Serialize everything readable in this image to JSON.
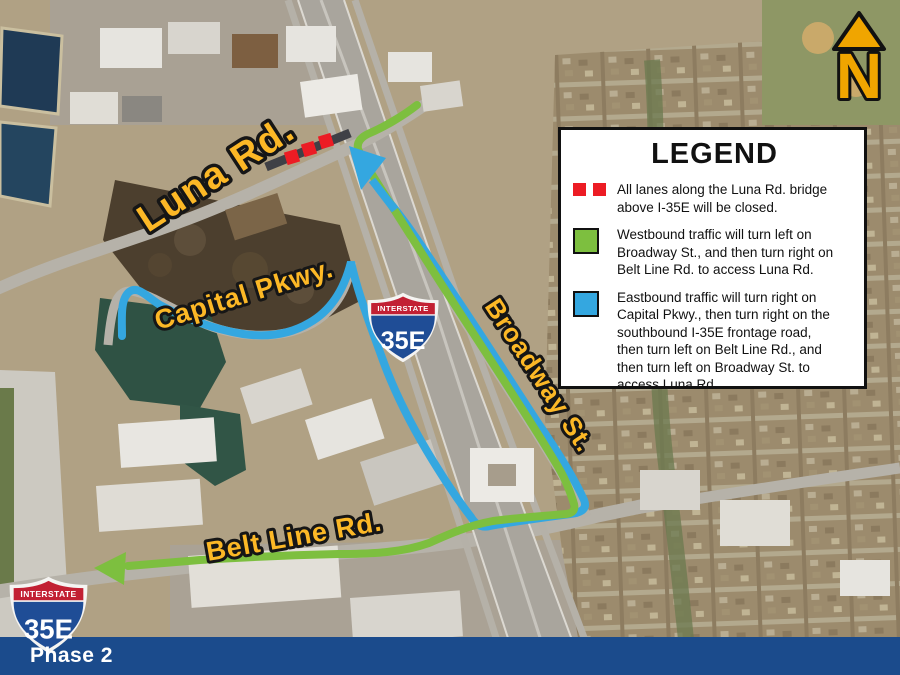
{
  "map": {
    "road_labels": {
      "luna": "Luna Rd.",
      "capital": "Capital Pkwy.",
      "broadway": "Broadway St.",
      "beltline": "Belt Line Rd."
    },
    "shield": {
      "top": "INTERSTATE",
      "number": "35E"
    },
    "north_letter": "N",
    "phase_label": "Phase 2"
  },
  "legend": {
    "title": "LEGEND",
    "items": [
      {
        "swatch": "red-dashes",
        "text": "All lanes along the Luna Rd. bridge\nabove I-35E will be closed."
      },
      {
        "swatch": "green-box",
        "text": "Westbound traffic will turn left on\nBroadway St., and then turn right on\nBelt Line Rd. to access Luna Rd."
      },
      {
        "swatch": "blue-box",
        "text": "Eastbound traffic will turn right on\nCapital Pkwy., then turn right on the\nsouthbound I-35E frontage road,\nthen turn left on Belt Line Rd., and\nthen turn left on Broadway St. to\naccess Luna Rd."
      }
    ]
  },
  "colors": {
    "route_green": "#7dbf3f",
    "route_blue": "#34a7e0",
    "closure_red": "#ec1c24",
    "label_yellow": "#fcb826",
    "bottom_bar_blue": "#1b4b8c",
    "shield_blue": "#1f4d96",
    "shield_red": "#c22033",
    "north_gold": "#f0a500"
  }
}
